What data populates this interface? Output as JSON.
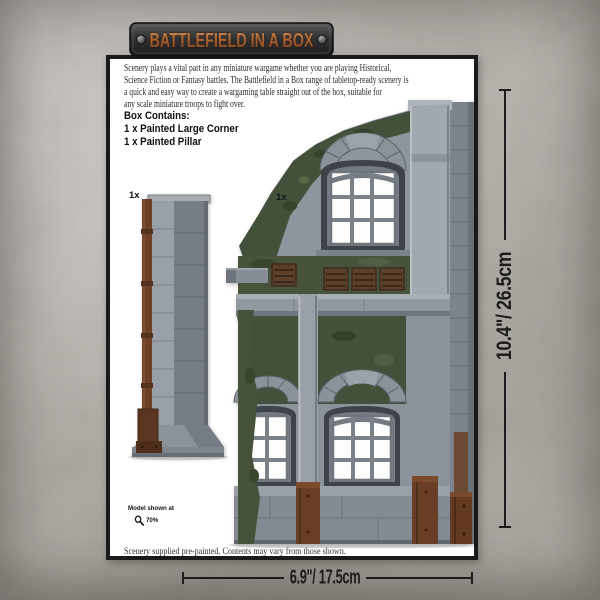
{
  "header": {
    "title": "BATTLEFIELD IN A BOX"
  },
  "intro": {
    "lines": [
      "Scenery plays a vital part in any miniature wargame whether you are playing Historical,",
      "Science Fiction or Fantasy battles. The Battlefield in a Box range of tabletop-ready scenery is",
      "a quick and easy way to create a wargaming table straight out of the box, suitable for",
      "any scale miniature troops to fight over."
    ]
  },
  "box_contains": {
    "heading": "Box Contains:",
    "items": [
      "1 x Painted Large Corner",
      "1 x Painted Pillar"
    ]
  },
  "models": {
    "pillar_count_label": "1x",
    "corner_count_label": "1x"
  },
  "scale_note": {
    "line1": "Model shown at",
    "percent": "70%",
    "icon": "magnifier-icon"
  },
  "dimensions": {
    "height": "10.4\"/ 26.5cm",
    "width": "6.9\"/ 17.5cm"
  },
  "footer": {
    "note": "Scenery supplied pre-painted. Contents may vary from those shown."
  },
  "colors": {
    "background": "#bdb9b3",
    "panel_border": "#1a1a1a",
    "rust_lettering": "#a65c2e",
    "stone_gray": "#8f959c",
    "moss_green": "#46533a",
    "wood_brown": "#5d4029",
    "rust_brown": "#6a3e26",
    "dimension_line": "#1c1c1c"
  }
}
